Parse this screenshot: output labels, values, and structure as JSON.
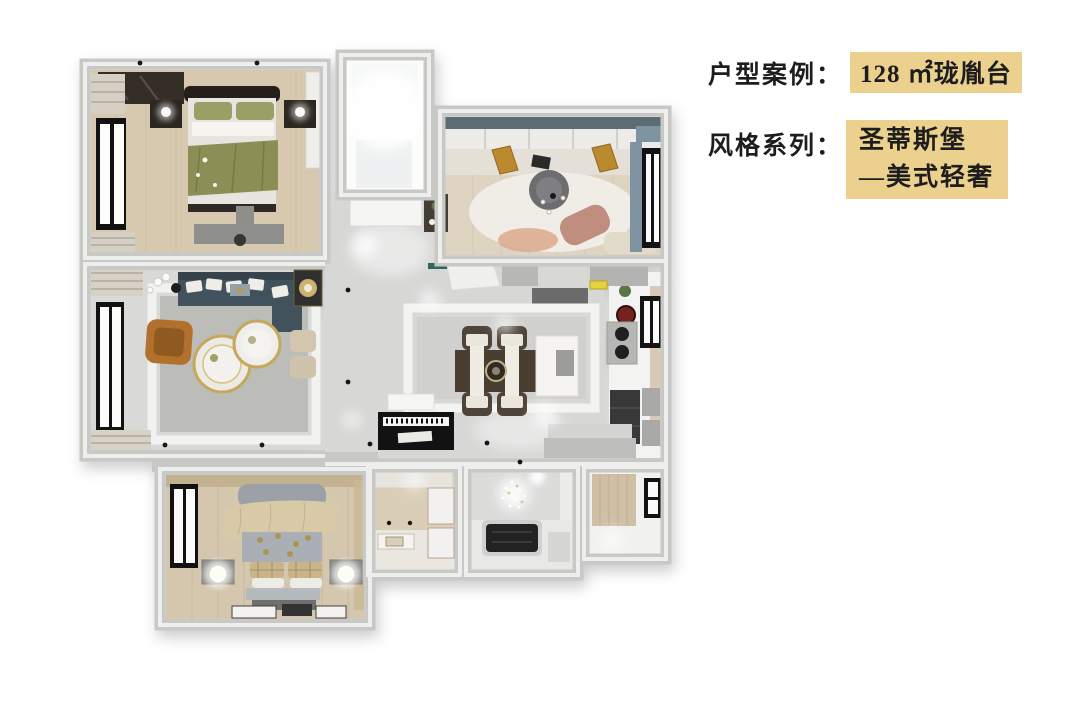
{
  "header": {
    "case": {
      "label": "户型案例：",
      "value": "128 ㎡珑胤台"
    },
    "style": {
      "label": "风格系列：",
      "value_line1": "圣蒂斯堡",
      "value_line2": "—美式轻奢"
    }
  },
  "colors": {
    "highlight": "#ecd18e",
    "text": "#1d1d1d",
    "wall": "#c8c8c6",
    "marble": "#d7d7d6",
    "wood": "#d7c9b0"
  },
  "floor_plan": {
    "description": "3D top-view rendering of a 128㎡ three-bedroom apartment"
  }
}
